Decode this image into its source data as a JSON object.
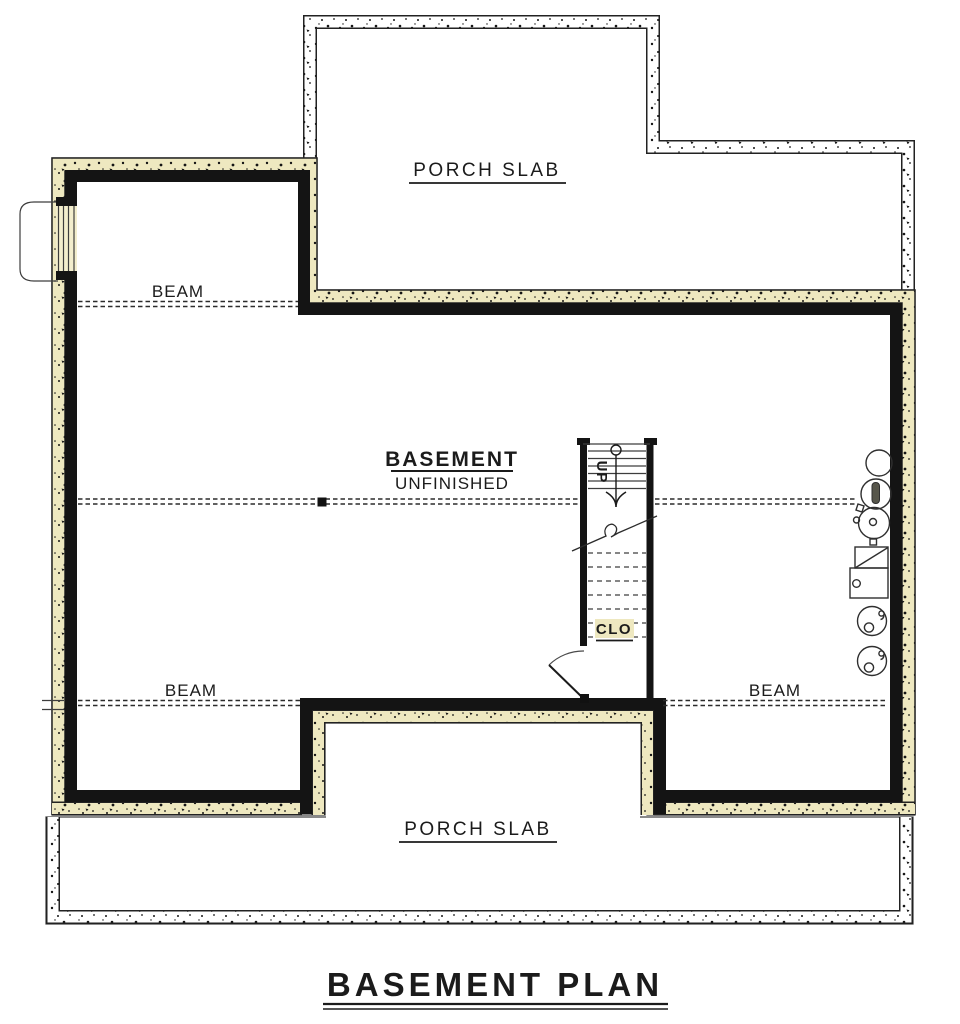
{
  "drawing": {
    "sheet_title": "BASEMENT PLAN",
    "labels": {
      "porch_top": "PORCH SLAB",
      "porch_bottom": "PORCH SLAB",
      "room_name": "BASEMENT",
      "room_status": "UNFINISHED",
      "closet": "CLO",
      "stair_direction": "UP",
      "beam_upper_left": "BEAM",
      "beam_lower_left": "BEAM",
      "beam_lower_right": "BEAM"
    },
    "fixtures": [
      "sump-pit",
      "water-softener",
      "water-heater",
      "furnace",
      "laundry-tub",
      "laundry-tub"
    ],
    "colors": {
      "floor": "#eee8c0",
      "porch": "#ffffff",
      "wall": "#141414",
      "linework": "#2b2b2b",
      "window_well": "#fdfbf0"
    }
  }
}
